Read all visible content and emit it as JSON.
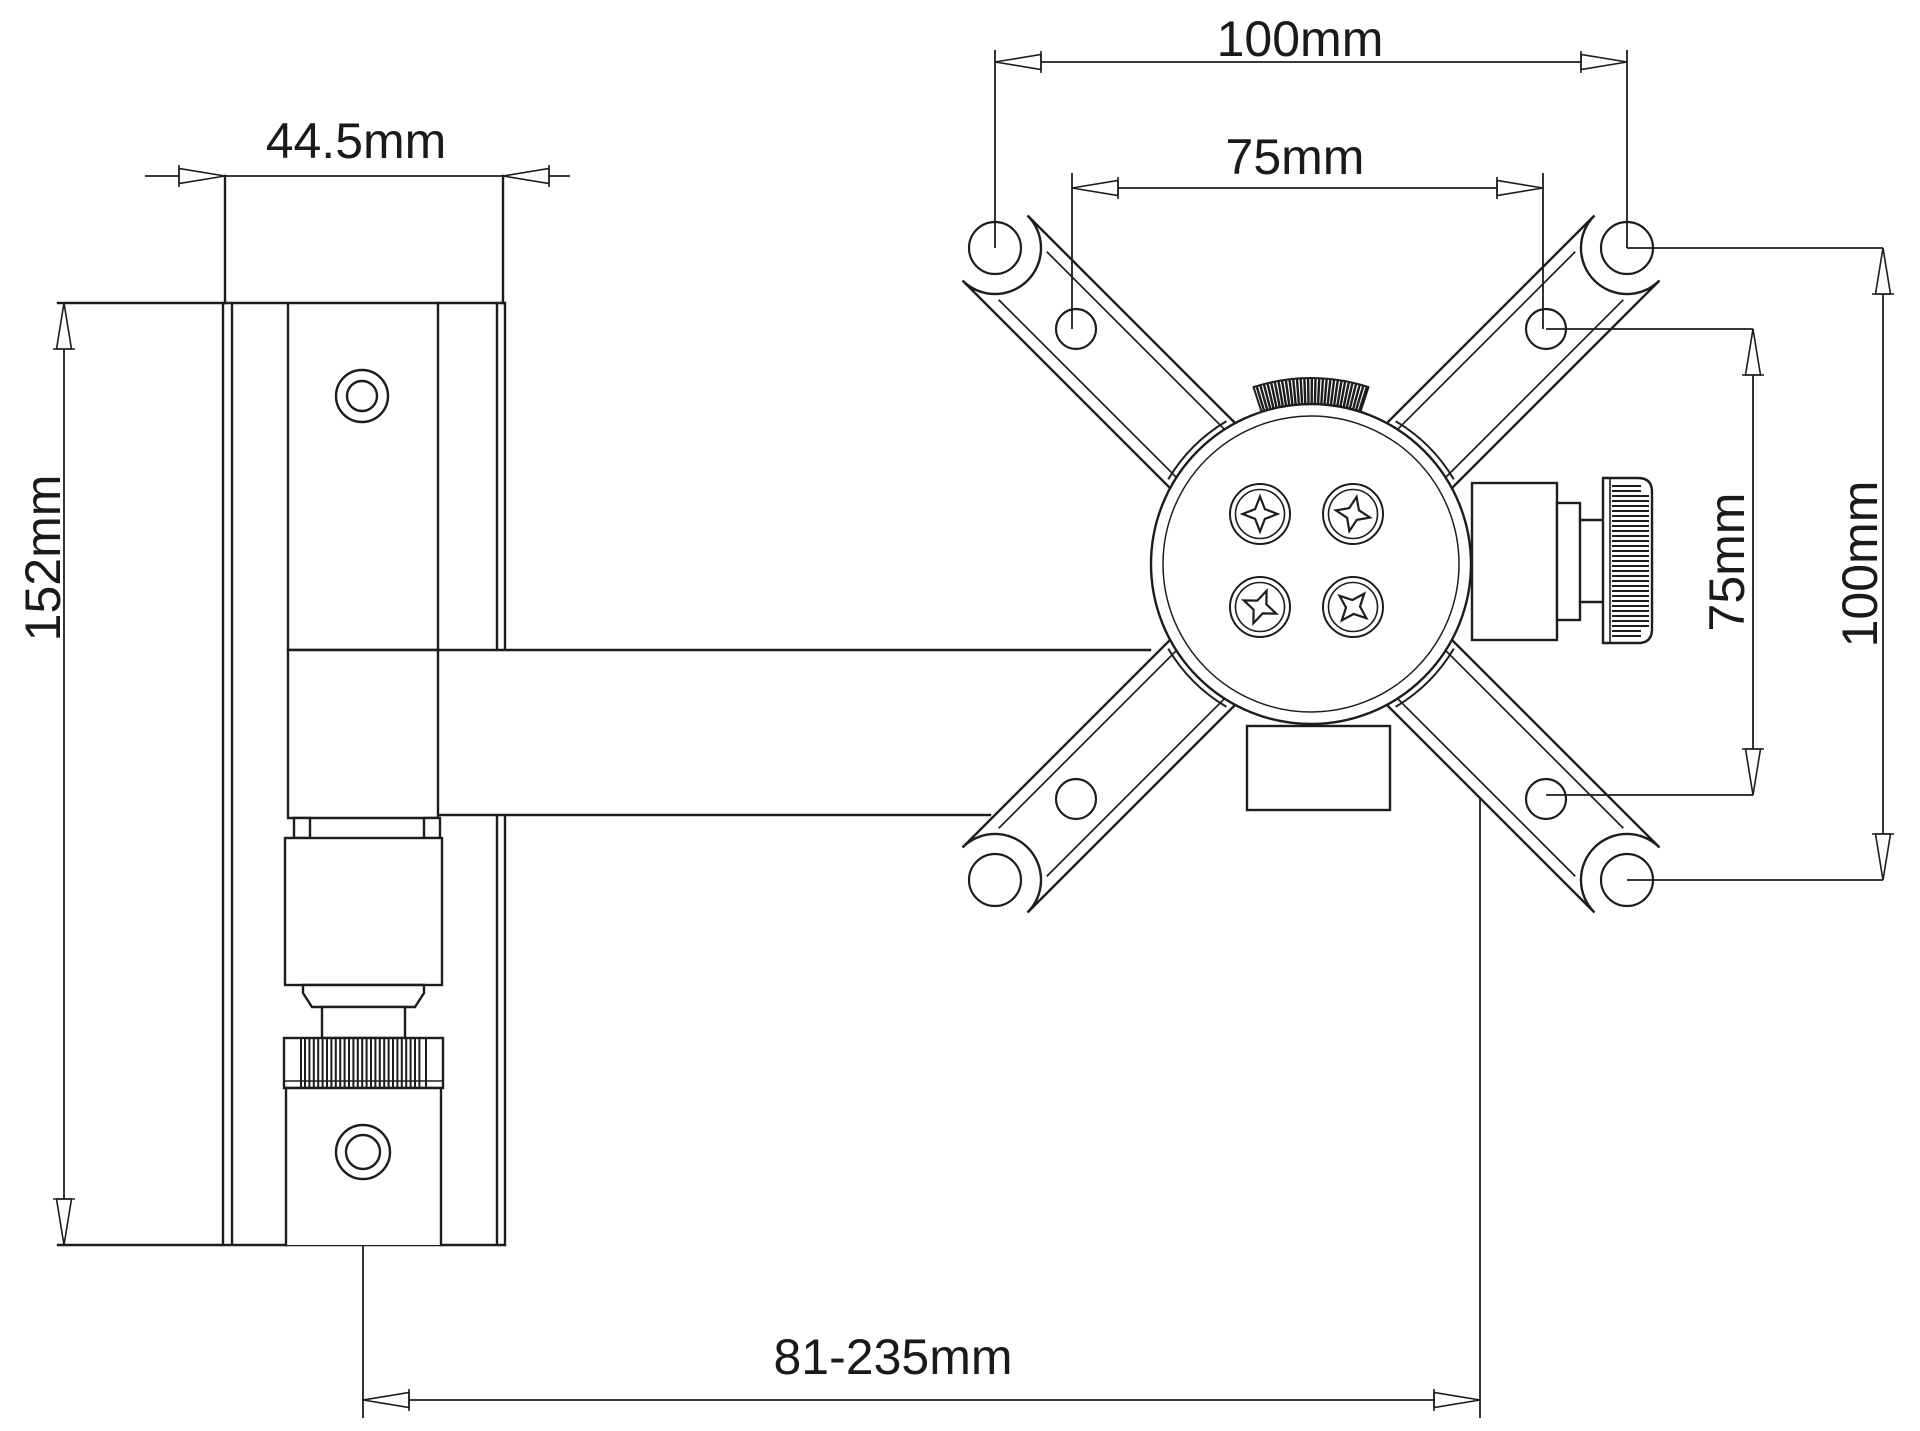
{
  "drawing": {
    "title": "wall-mount-bracket-dimension-drawing",
    "colors": {
      "line": "#1d1d1d",
      "background": "#ffffff"
    },
    "labels": {
      "wall_plate_width": "44.5mm",
      "wall_plate_height": "152mm",
      "vesa_outer_horizontal": "100mm",
      "vesa_inner_horizontal": "75mm",
      "vesa_inner_vertical": "75mm",
      "vesa_outer_vertical": "100mm",
      "arm_extension_range": "81-235mm"
    }
  }
}
